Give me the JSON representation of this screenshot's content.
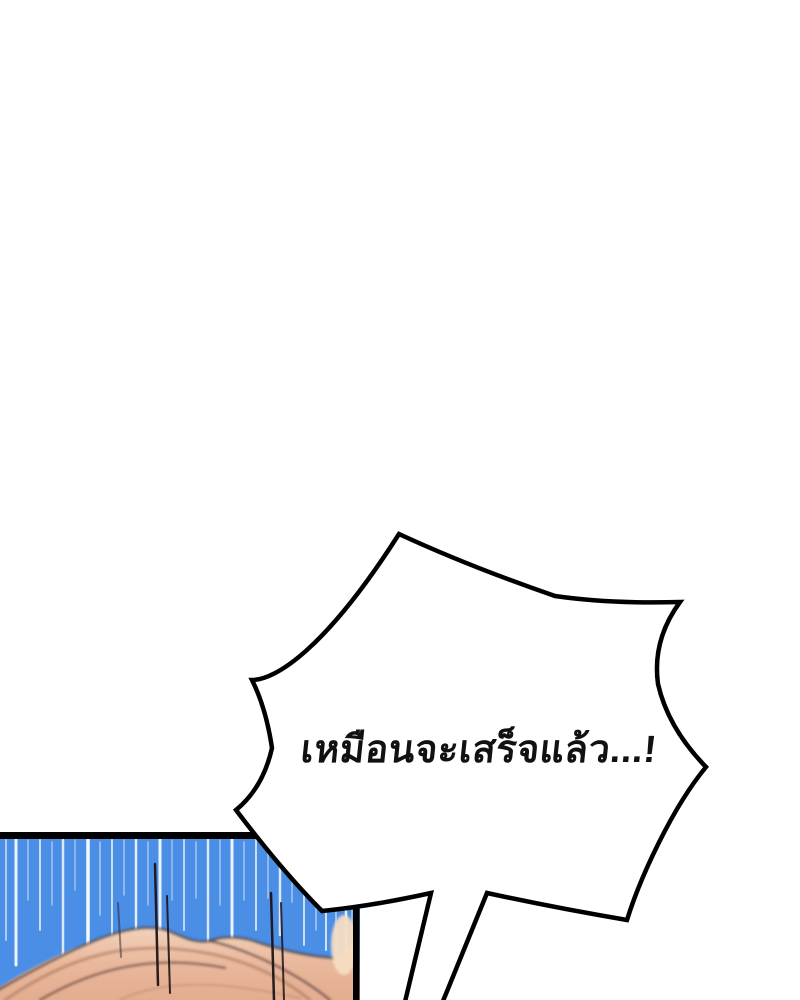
{
  "scene": {
    "kind": "webtoon-comic-panel",
    "background_color": "#ffffff"
  },
  "speech_bubble": {
    "text": "เหมือนจะเสร็จแล้ว...!",
    "fill": "#ffffff",
    "stroke": "#000000",
    "text_color": "#111111"
  },
  "panel": {
    "background": "#4a8ee6",
    "border_color": "#000000",
    "speed_line_color": "#ffffff",
    "speed_lines": [
      [
        6,
        840,
        940,
        2,
        0.55
      ],
      [
        16,
        840,
        965,
        3,
        0.9
      ],
      [
        28,
        840,
        900,
        1.5,
        0.5
      ],
      [
        40,
        840,
        930,
        2,
        0.7
      ],
      [
        52,
        842,
        905,
        1.5,
        0.5
      ],
      [
        63,
        840,
        955,
        2.5,
        0.8
      ],
      [
        75,
        840,
        890,
        1.5,
        0.45
      ],
      [
        88,
        840,
        960,
        3.5,
        0.95
      ],
      [
        100,
        842,
        915,
        1.5,
        0.55
      ],
      [
        112,
        840,
        945,
        2,
        0.7
      ],
      [
        124,
        840,
        895,
        1.5,
        0.5
      ],
      [
        136,
        840,
        955,
        2.5,
        0.85
      ],
      [
        148,
        842,
        905,
        1.5,
        0.5
      ],
      [
        160,
        840,
        965,
        3,
        0.9
      ],
      [
        172,
        840,
        900,
        1.5,
        0.45
      ],
      [
        184,
        840,
        930,
        2,
        0.65
      ],
      [
        196,
        842,
        898,
        1.5,
        0.5
      ],
      [
        208,
        840,
        950,
        2.5,
        0.8
      ],
      [
        220,
        840,
        905,
        1.5,
        0.5
      ],
      [
        232,
        840,
        940,
        3,
        0.9
      ],
      [
        244,
        842,
        900,
        1.5,
        0.5
      ],
      [
        256,
        840,
        930,
        2,
        0.7
      ],
      [
        268,
        840,
        898,
        1.5,
        0.5
      ],
      [
        280,
        840,
        935,
        2.5,
        0.8
      ],
      [
        292,
        842,
        902,
        1.5,
        0.5
      ],
      [
        304,
        840,
        945,
        2,
        0.7
      ],
      [
        316,
        842,
        930,
        1.5,
        0.55
      ],
      [
        326,
        845,
        950,
        2,
        0.75
      ],
      [
        336,
        850,
        958,
        1.5,
        0.6
      ],
      [
        346,
        855,
        962,
        2.5,
        0.85
      ],
      [
        352,
        860,
        930,
        1.5,
        0.5
      ]
    ],
    "hair": {
      "base": "#e9b89c",
      "light": "#f6ddc3",
      "shade": "#a76f57",
      "dark": "#4a3033",
      "strand_color": "#1e1416",
      "strands": [
        [
          155,
          864,
          158,
          985,
          2.5,
          0.95
        ],
        [
          167,
          896,
          170,
          993,
          2,
          0.9
        ],
        [
          271,
          893,
          274,
          1000,
          2.5,
          0.95
        ],
        [
          281,
          903,
          284,
          1000,
          2,
          0.85
        ],
        [
          118,
          903,
          121,
          957,
          2,
          0.45
        ]
      ]
    }
  }
}
